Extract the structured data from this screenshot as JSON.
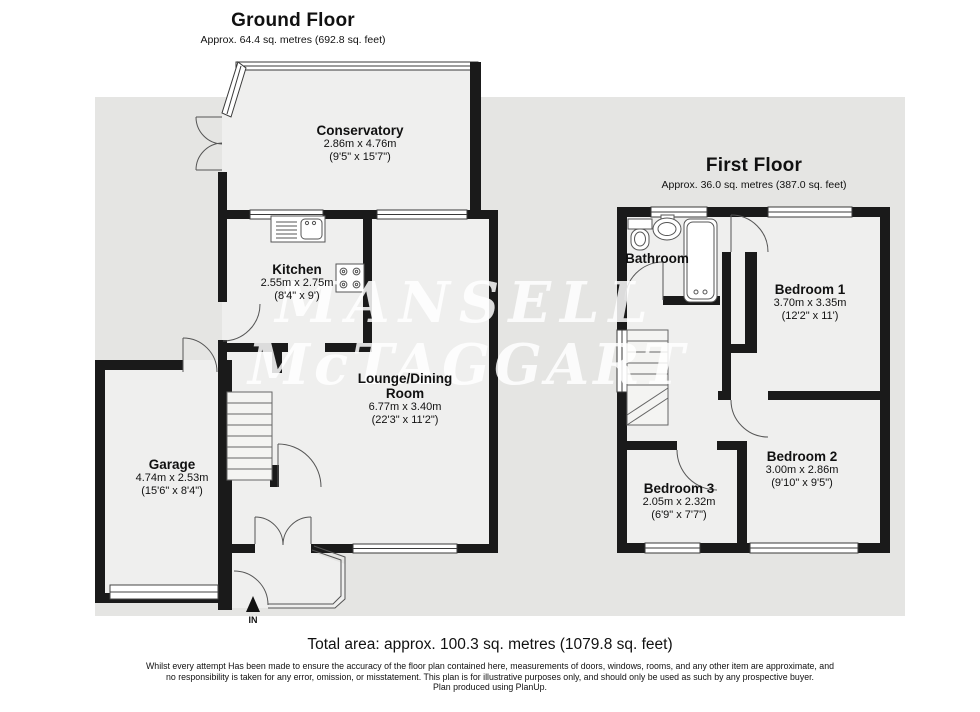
{
  "colors": {
    "outside_ground": "#e5e5e3",
    "room_interior": "#efefee",
    "wall": "#1a1a1a",
    "watermark_white": "#ffffff"
  },
  "ground_floor": {
    "title": "Ground Floor",
    "subtitle": "Approx. 64.4 sq. metres (692.8 sq. feet)",
    "rooms": {
      "conservatory": {
        "name": "Conservatory",
        "metric": "2.86m x 4.76m",
        "imperial": "(9'5\" x 15'7\")"
      },
      "kitchen": {
        "name": "Kitchen",
        "metric": "2.55m x 2.75m",
        "imperial": "(8'4\" x 9')"
      },
      "lounge": {
        "name": "Lounge/Dining Room",
        "metric": "6.77m x 3.40m",
        "imperial": "(22'3\" x 11'2\")"
      },
      "garage": {
        "name": "Garage",
        "metric": "4.74m x 2.53m",
        "imperial": "(15'6\" x 8'4\")"
      }
    },
    "entrance_label": "IN"
  },
  "first_floor": {
    "title": "First Floor",
    "subtitle": "Approx. 36.0 sq. metres (387.0 sq. feet)",
    "rooms": {
      "bathroom": {
        "name": "Bathroom"
      },
      "bedroom1": {
        "name": "Bedroom 1",
        "metric": "3.70m x 3.35m",
        "imperial": "(12'2\" x 11')"
      },
      "bedroom2": {
        "name": "Bedroom 2",
        "metric": "3.00m x 2.86m",
        "imperial": "(9'10\" x 9'5\")"
      },
      "bedroom3": {
        "name": "Bedroom 3",
        "metric": "2.05m x 2.32m",
        "imperial": "(6'9\" x 7'7\")"
      }
    }
  },
  "watermark": {
    "line1": "MANSELL",
    "line2": "McTAGGART"
  },
  "footer": {
    "total_area": "Total area: approx. 100.3 sq. metres (1079.8 sq. feet)",
    "disclaimer": "Whilst every attempt Has been made to ensure the accuracy of the floor plan contained here, measurements of doors, windows, rooms, and any other item are approximate, and no responsibility is taken for any error, omission, or misstatement. This plan is for illustrative purposes only, and should only be used as such by any prospective buyer.",
    "produced": "Plan produced using PlanUp."
  }
}
